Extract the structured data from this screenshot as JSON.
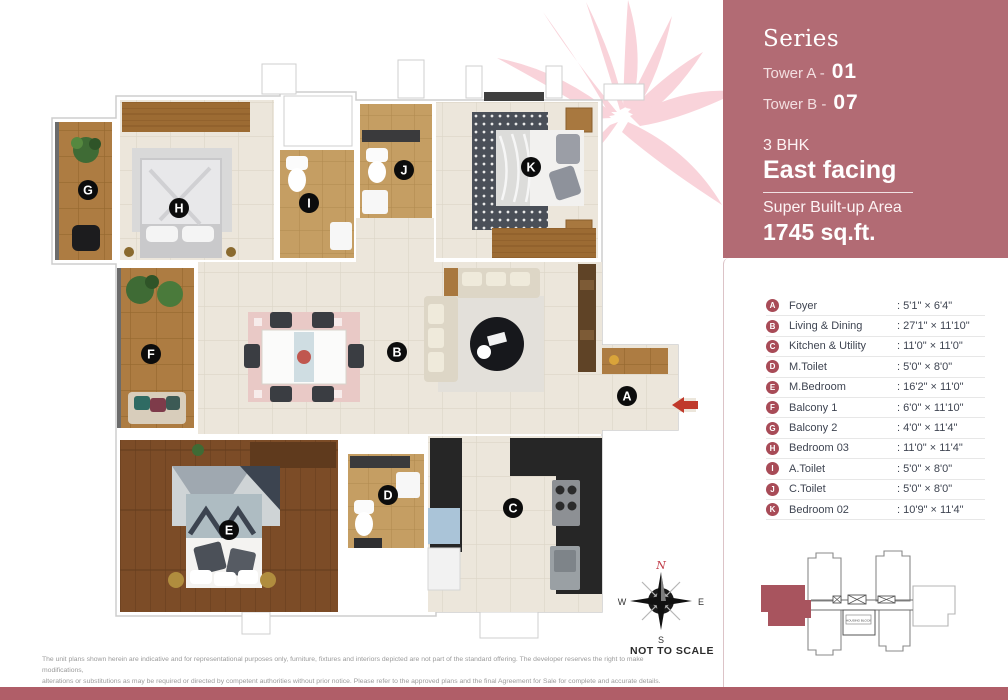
{
  "panel": {
    "series_label": "Series",
    "tower_a_label": "Tower A -",
    "tower_a_value": "01",
    "tower_b_label": "Tower B -",
    "tower_b_value": "07",
    "bhk": "3 BHK",
    "facing": "East facing",
    "area_label": "Super Built-up Area",
    "area_value": "1745 sq.ft.",
    "bg_color": "#b26b74"
  },
  "legend": {
    "badge_color": "#a84b57",
    "items": [
      {
        "letter": "A",
        "name": "Foyer",
        "dim": ": 5'1\" × 6'4\""
      },
      {
        "letter": "B",
        "name": "Living & Dining",
        "dim": ": 27'1\" × 11'10\""
      },
      {
        "letter": "C",
        "name": "Kitchen & Utility",
        "dim": ": 11'0\" × 11'0\""
      },
      {
        "letter": "D",
        "name": "M.Toilet",
        "dim": ": 5'0\" × 8'0\""
      },
      {
        "letter": "E",
        "name": "M.Bedroom",
        "dim": ": 16'2\" × 11'0\""
      },
      {
        "letter": "F",
        "name": "Balcony 1",
        "dim": ": 6'0\" × 11'10\""
      },
      {
        "letter": "G",
        "name": "Balcony 2",
        "dim": ": 4'0\" × 11'4\""
      },
      {
        "letter": "H",
        "name": "Bedroom 03",
        "dim": ": 11'0\" × 11'4\""
      },
      {
        "letter": "I",
        "name": "A.Toilet",
        "dim": ": 5'0\" × 8'0\""
      },
      {
        "letter": "J",
        "name": "C.Toilet",
        "dim": ": 5'0\" × 8'0\""
      },
      {
        "letter": "K",
        "name": "Bedroom 02",
        "dim": ": 10'9\" × 11'4\""
      }
    ]
  },
  "plan": {
    "labels": [
      "G",
      "H",
      "I",
      "J",
      "K",
      "F",
      "B",
      "A",
      "E",
      "D",
      "C"
    ]
  },
  "compass": {
    "n": "N",
    "e": "E",
    "s": "S",
    "w": "W",
    "not_to_scale": "NOT TO SCALE"
  },
  "keyplan": {
    "label": "HOUSING BLOCK",
    "highlight_color": "#a8545e"
  },
  "footer": {
    "disclaimer_line1": "The unit plans shown herein are indicative and for representational purposes only, furniture, fixtures and interiors depicted are not part of the standard offering. The developer reserves the right to make modifications,",
    "disclaimer_line2": "alterations or substitutions as may be required or directed by competent authorities without prior notice. Please refer to the approved plans and the final Agreement for Sale for complete and accurate details.",
    "bar_color": "#b05e68"
  }
}
